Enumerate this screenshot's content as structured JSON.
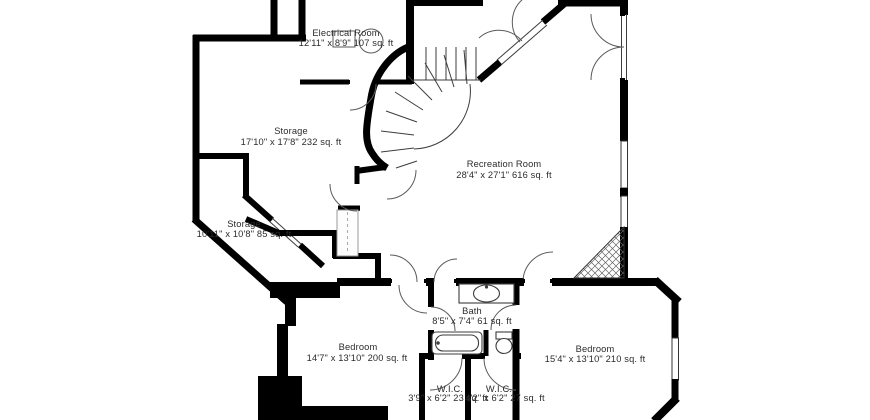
{
  "colors": {
    "background": "#ffffff",
    "walls": "#000000",
    "thin_lines": "#4a4a4a",
    "text": "#2b2b2b"
  },
  "rooms": [
    {
      "id": "electrical-room",
      "name": "Electrical Room",
      "dims": "12'11\" x 8'9\" 107 sq. ft"
    },
    {
      "id": "storage-upper",
      "name": "Storage",
      "dims": "17'10\" x 17'8\" 232 sq. ft"
    },
    {
      "id": "storage-lower",
      "name": "Storage",
      "dims": "10'11\" x 10'8\" 85 sq. ft"
    },
    {
      "id": "recreation-room",
      "name": "Recreation Room",
      "dims": "28'4\" x 27'1\" 616 sq. ft"
    },
    {
      "id": "bath",
      "name": "Bath",
      "dims": "8'5\" x 7'4\" 61 sq. ft"
    },
    {
      "id": "bedroom-left",
      "name": "Bedroom",
      "dims": "14'7\" x 13'10\" 200 sq. ft"
    },
    {
      "id": "bedroom-right",
      "name": "Bedroom",
      "dims": "15'4\" x 13'10\" 210 sq. ft"
    },
    {
      "id": "wic-left",
      "name": "W.I.C.",
      "dims": "3'9\" x 6'2\" 23 sq. ft"
    },
    {
      "id": "wic-right",
      "name": "W.I.C.",
      "dims": "4'2\" x 6'2\" 27 sq. ft"
    }
  ]
}
